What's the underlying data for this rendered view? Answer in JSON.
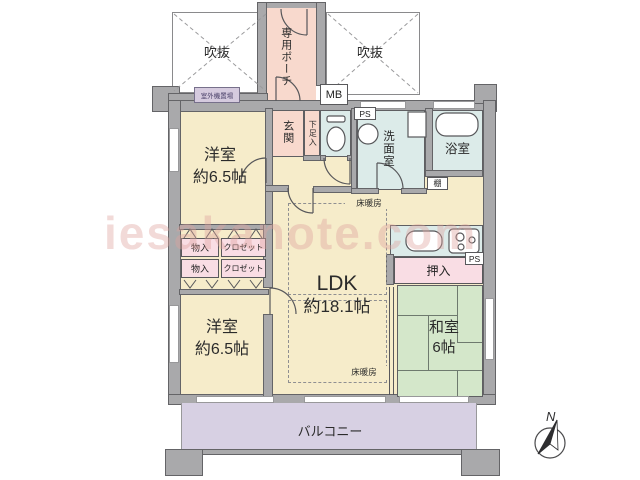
{
  "labels": {
    "void_left": "吹抜",
    "void_right": "吹抜",
    "private_porch": "専用ポーチ",
    "meter_box": "MB",
    "outdoor_unit_area": "室外機置場",
    "pipe_space_top": "PS",
    "pipe_space_side": "PS",
    "entrance": "玄関",
    "shoe_cabinet": "下足入",
    "washroom": "洗面室",
    "bathroom": "浴室",
    "shelf": "棚",
    "western_room_upper_name": "洋室",
    "western_room_upper_size": "約6.5帖",
    "western_room_lower_name": "洋室",
    "western_room_lower_size": "約6.5帖",
    "storage_upper": "物入",
    "storage_lower": "物入",
    "closet_upper": "クロゼット",
    "closet_lower": "クロゼット",
    "ldk_name": "LDK",
    "ldk_size": "約18.1帖",
    "floor_heating_upper": "床暖房",
    "floor_heating_lower": "床暖房",
    "oshiire": "押入",
    "japanese_room_name": "和室",
    "japanese_room_size": "6帖",
    "balcony": "バルコニー",
    "compass_north": "N",
    "watermark": "iesakanote.com"
  },
  "colors": {
    "wall_gray": "#a9a9ab",
    "wall_outline": "#58585b",
    "room_beige": "#f6ecca",
    "entrance_pink": "#f8d9cd",
    "closet_pink": "#f9dde4",
    "wet_area_blue": "#dcebe9",
    "tatami_green": "#d4e7ca",
    "balcony_purple": "#d7d0e3",
    "watermark_pink": "#dea29e"
  }
}
